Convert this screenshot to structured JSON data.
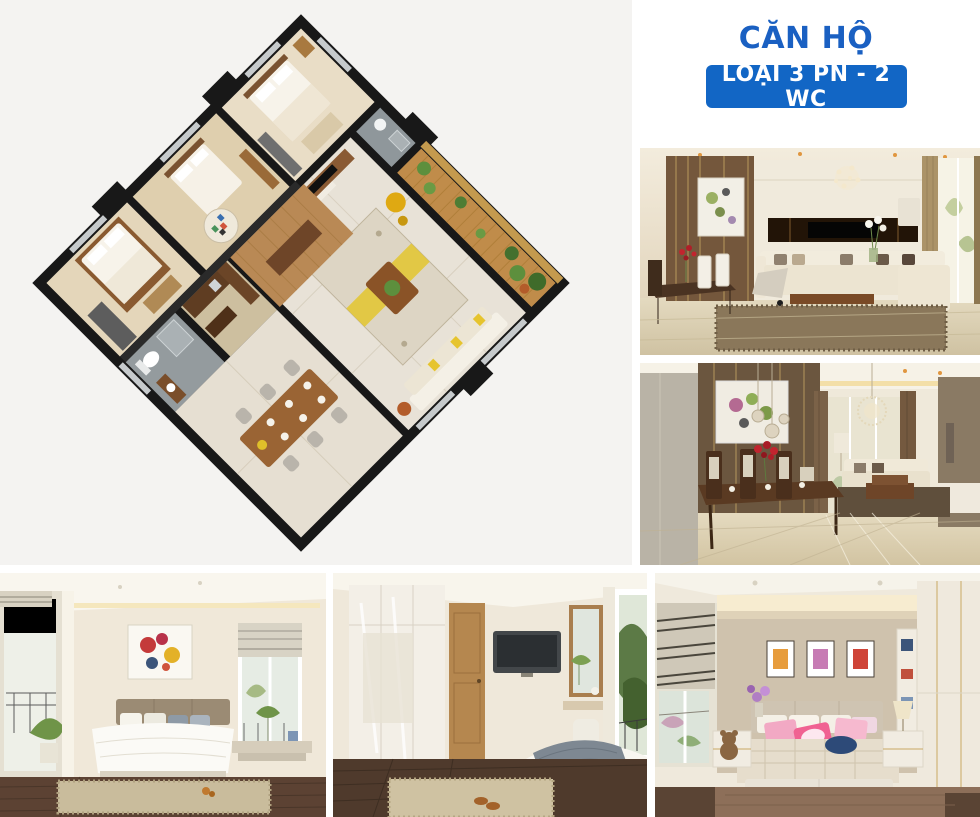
{
  "header": {
    "title": "CĂN HỘ",
    "badge_label": "LOẠI 3 PN - 2 WC"
  },
  "colors": {
    "accent": "#1266c5",
    "title": "#1a60c2",
    "badge_text": "#ffffff",
    "plan_bg": "#f4f3f1",
    "page_bg": "#ffffff"
  },
  "floor_plan": {
    "type": "isometric-3d-apartment-render",
    "rotation_deg": 45,
    "rooms": [
      "bedroom-1",
      "bedroom-2",
      "bedroom-3",
      "bathroom-1",
      "bathroom-2",
      "living-room",
      "dining-area",
      "kitchen",
      "balcony-garden"
    ],
    "palette": {
      "walls": "#181818",
      "wood_floor": "#b98955",
      "marble_floor": "#e8e2d7",
      "balcony_wood": "#c08c4a",
      "accent_chair": "#dfa912",
      "plants": "#5d8f3d"
    }
  },
  "photos": [
    {
      "id": "living-room-1",
      "name": "living-room-sofa-photo"
    },
    {
      "id": "living-room-2",
      "name": "dining-living-photo"
    },
    {
      "id": "bedroom-1",
      "name": "master-bedroom-photo"
    },
    {
      "id": "bedroom-2",
      "name": "bedroom-wardrobe-photo"
    },
    {
      "id": "bedroom-3",
      "name": "kids-bedroom-photo"
    }
  ]
}
